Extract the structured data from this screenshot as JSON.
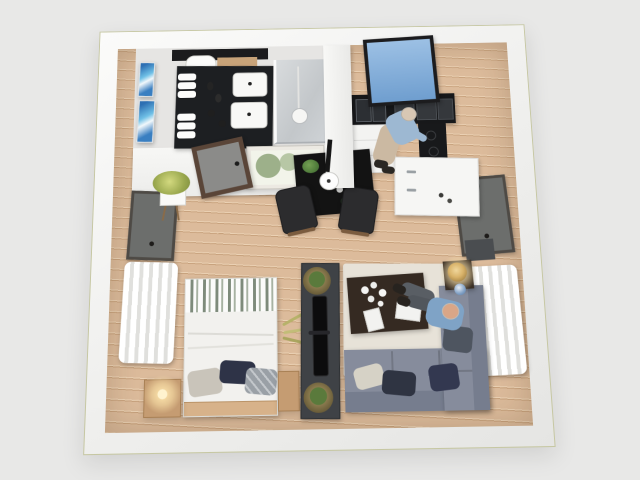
{
  "scene": {
    "description": "3D top-down rendering of a studio apartment floor plan",
    "background_color": "#e8e8e7",
    "outer_wall_color": "#f6f6f4",
    "outer_wall_outline": "#c6c7a2",
    "floor_wood": "#dcbb9b",
    "floor_seam": "#c7a17c"
  },
  "rooms": {
    "bathroom": {
      "label": "bathroom",
      "items": [
        "double-sink vanity",
        "black marble countertop",
        "rolled towels",
        "toilet",
        "walk-in shower",
        "blue abstract wall art",
        "grey door",
        "botanical framed print"
      ],
      "floor": "#e6e5e3",
      "vanity_counter": "#1d1f22",
      "sink": "#f8f8f6",
      "shower_tile": "#cfd2d4",
      "art_blue": "#3a7fc1",
      "door": "#8b8b89",
      "door_frame": "#5a4538"
    },
    "kitchen": {
      "label": "kitchen",
      "items": [
        "skylight window with sky view",
        "black upper cabinets",
        "double sink",
        "white lower cabinets",
        "cooktop",
        "white island"
      ],
      "upper_cabinets": "#17181a",
      "lower_cabinets": "#f3f3f1",
      "island": "#f6f6f4",
      "window_sky_top": "#9cc0e4",
      "window_sky_bottom": "#6f9ecf",
      "stove": "#18191b"
    },
    "dining": {
      "label": "dining area",
      "items": [
        "black dining table",
        "two chairs",
        "white pendant lamp",
        "potted plant",
        "glassware"
      ],
      "table": "#131313",
      "chair": "#2c2c2e",
      "pendant": "#fdfdfd",
      "plant": "#4e7a3a"
    },
    "bedroom": {
      "label": "sleeping area",
      "items": [
        "double bed",
        "striped blanket",
        "three pillows",
        "wood headboard",
        "nightstands",
        "glowing wall sconce",
        "white curtains",
        "shuttered window",
        "potted plant on stand"
      ],
      "duvet": "#f2f1ee",
      "blanket_stripe": "#7e8b7b",
      "pillow_navy": "#2e3347",
      "pillow_plaid": "#9aa0a6",
      "pillow_beige": "#c9c4ba",
      "headboard": "#d7b28a",
      "nightstand": "#c59c72",
      "curtain": "#ffffff",
      "window_shutter": "#6c6e6c",
      "sconce_glow": "#ffe7ae"
    },
    "living": {
      "label": "living area",
      "items": [
        "grey L-sectional sofa",
        "throw pillows",
        "area rug",
        "dark wood coffee table",
        "white flowers",
        "magazines",
        "side table with brass lamp",
        "blue vase",
        "white curtains",
        "media console with TV",
        "plants in woven baskets"
      ],
      "sofa": "#868c9c",
      "sofa_back": "#767d8e",
      "rug": "#e7e2d8",
      "coffee_table": "#352a22",
      "side_table": "#3a2f26",
      "lamp_brass": "#d9b36a",
      "vase": "#7f9fc4",
      "curtain": "#ffffff",
      "tv_console": "#3f4246",
      "tv": "#0c0c0d",
      "basket": "#8a7a4e",
      "pillow_navy": "#2f3442",
      "pillow_beige": "#d6d2c6",
      "throw": "#4e5560"
    }
  },
  "people": [
    {
      "name": "person cooking at stove",
      "room": "kitchen",
      "shirt": "#9db8d2",
      "pants": "#cbb9a2",
      "skin": "#d8c7b4"
    },
    {
      "name": "person seated on sofa with feet on coffee table",
      "room": "living",
      "shirt": "#7fa3c6",
      "pants": "#595e64",
      "skin": "#d9a687"
    }
  ]
}
